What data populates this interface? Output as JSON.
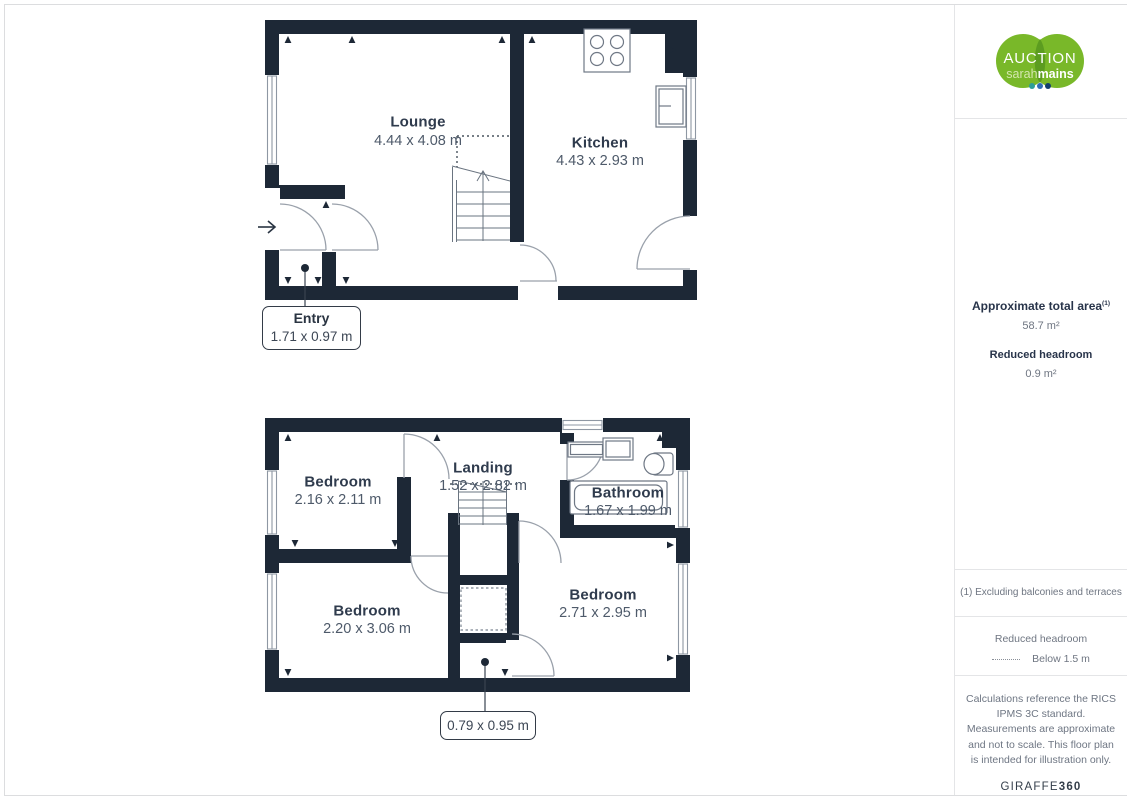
{
  "floors": {
    "ground": {
      "rooms": [
        {
          "name": "Lounge",
          "dims": "4.44 x 4.08 m"
        },
        {
          "name": "Kitchen",
          "dims": "4.43 x 2.93 m"
        }
      ],
      "callout": {
        "name": "Entry",
        "dims": "1.71 x 0.97 m"
      }
    },
    "first": {
      "rooms": [
        {
          "name": "Bedroom",
          "dims": "2.16 x 2.11 m"
        },
        {
          "name": "Landing",
          "dims": "1.52 x 2.82 m"
        },
        {
          "name": "Bathroom",
          "dims": "1.67 x 1.99 m"
        },
        {
          "name": "Bedroom",
          "dims": "2.20 x 3.06 m"
        },
        {
          "name": "Bedroom",
          "dims": "2.71 x 2.95 m"
        }
      ],
      "callout": {
        "dims": "0.79 x 0.95 m"
      }
    }
  },
  "branding": {
    "logo": {
      "line1": "AUCTION",
      "line2_light": "sarah",
      "line2_bold": "mains"
    },
    "footer_brand": {
      "name": "GIRAFFE",
      "suffix": "360"
    }
  },
  "sidebar": {
    "area": {
      "title": "Approximate total area",
      "title_superscript": "(1)",
      "value": "58.7 m²",
      "reduced_title": "Reduced headroom",
      "reduced_value": "0.9 m²"
    },
    "footnote": "(1) Excluding balconies and terraces",
    "legend": {
      "title": "Reduced headroom",
      "label": "Below 1.5 m"
    },
    "disclaimer": "Calculations reference the RICS IPMS 3C standard. Measurements are approximate and not to scale. This floor plan is intended for illustration only."
  },
  "colors": {
    "wall": "#1d2836",
    "logo_green": "#79b829",
    "leaf_green": "#5c9c20",
    "text_dark": "#2f3b4d",
    "text_gray": "#6f7682",
    "divider": "#e4e5e7",
    "dot_teal": "#2e9e99",
    "dot_blue": "#2f6eb4",
    "dot_navy": "#123f6e"
  }
}
